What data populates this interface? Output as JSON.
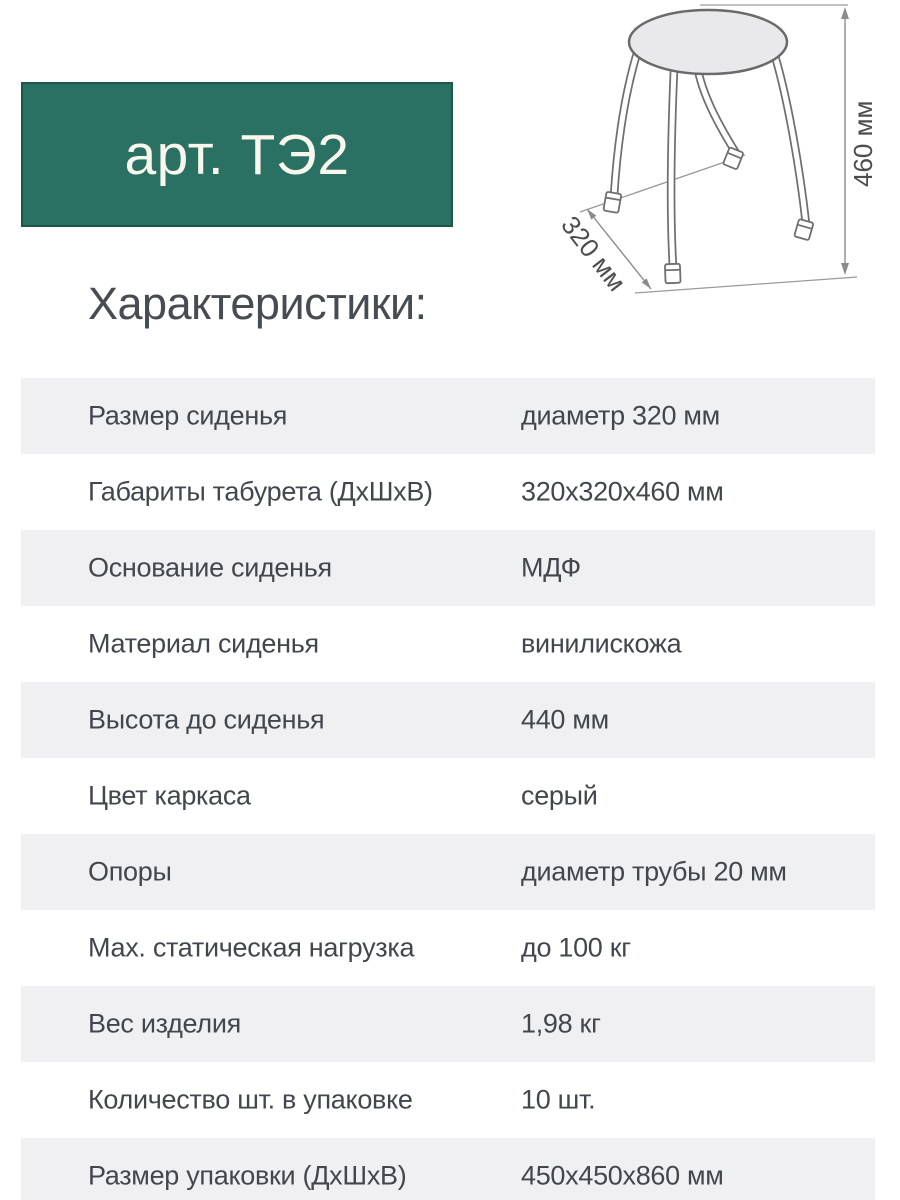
{
  "badge": {
    "label": "арт. ТЭ2"
  },
  "heading": "Характеристики:",
  "diagram": {
    "name": "stool-technical-drawing",
    "height_label": "460 мм",
    "depth_label": "320 мм"
  },
  "specs": {
    "rows": [
      {
        "label": "Размер сиденья",
        "value": "диаметр 320 мм"
      },
      {
        "label": "Габариты табурета (ДхШхВ)",
        "value": "320x320x460 мм"
      },
      {
        "label": "Основание сиденья",
        "value": "МДФ"
      },
      {
        "label": "Материал сиденья",
        "value": "винилискожа"
      },
      {
        "label": "Высота до сиденья",
        "value": "440 мм"
      },
      {
        "label": "Цвет каркаса",
        "value": "серый"
      },
      {
        "label": "Опоры",
        "value": "диаметр трубы 20 мм"
      },
      {
        "label": "Мах. статическая нагрузка",
        "value": "до 100 кг"
      },
      {
        "label": "Вес изделия",
        "value": "1,98 кг"
      },
      {
        "label": "Количество шт. в упаковке",
        "value": "10 шт."
      },
      {
        "label": "Размер упаковки (ДхШхВ)",
        "value": "450x450x860 мм"
      }
    ]
  },
  "colors": {
    "badge_bg": "#2a7164",
    "badge_border": "#1e564a",
    "badge_text": "#f9f7ed",
    "row_alt_bg": "#f0f0f2",
    "text": "#42474e",
    "drawing_stroke": "#6f6f6f"
  }
}
